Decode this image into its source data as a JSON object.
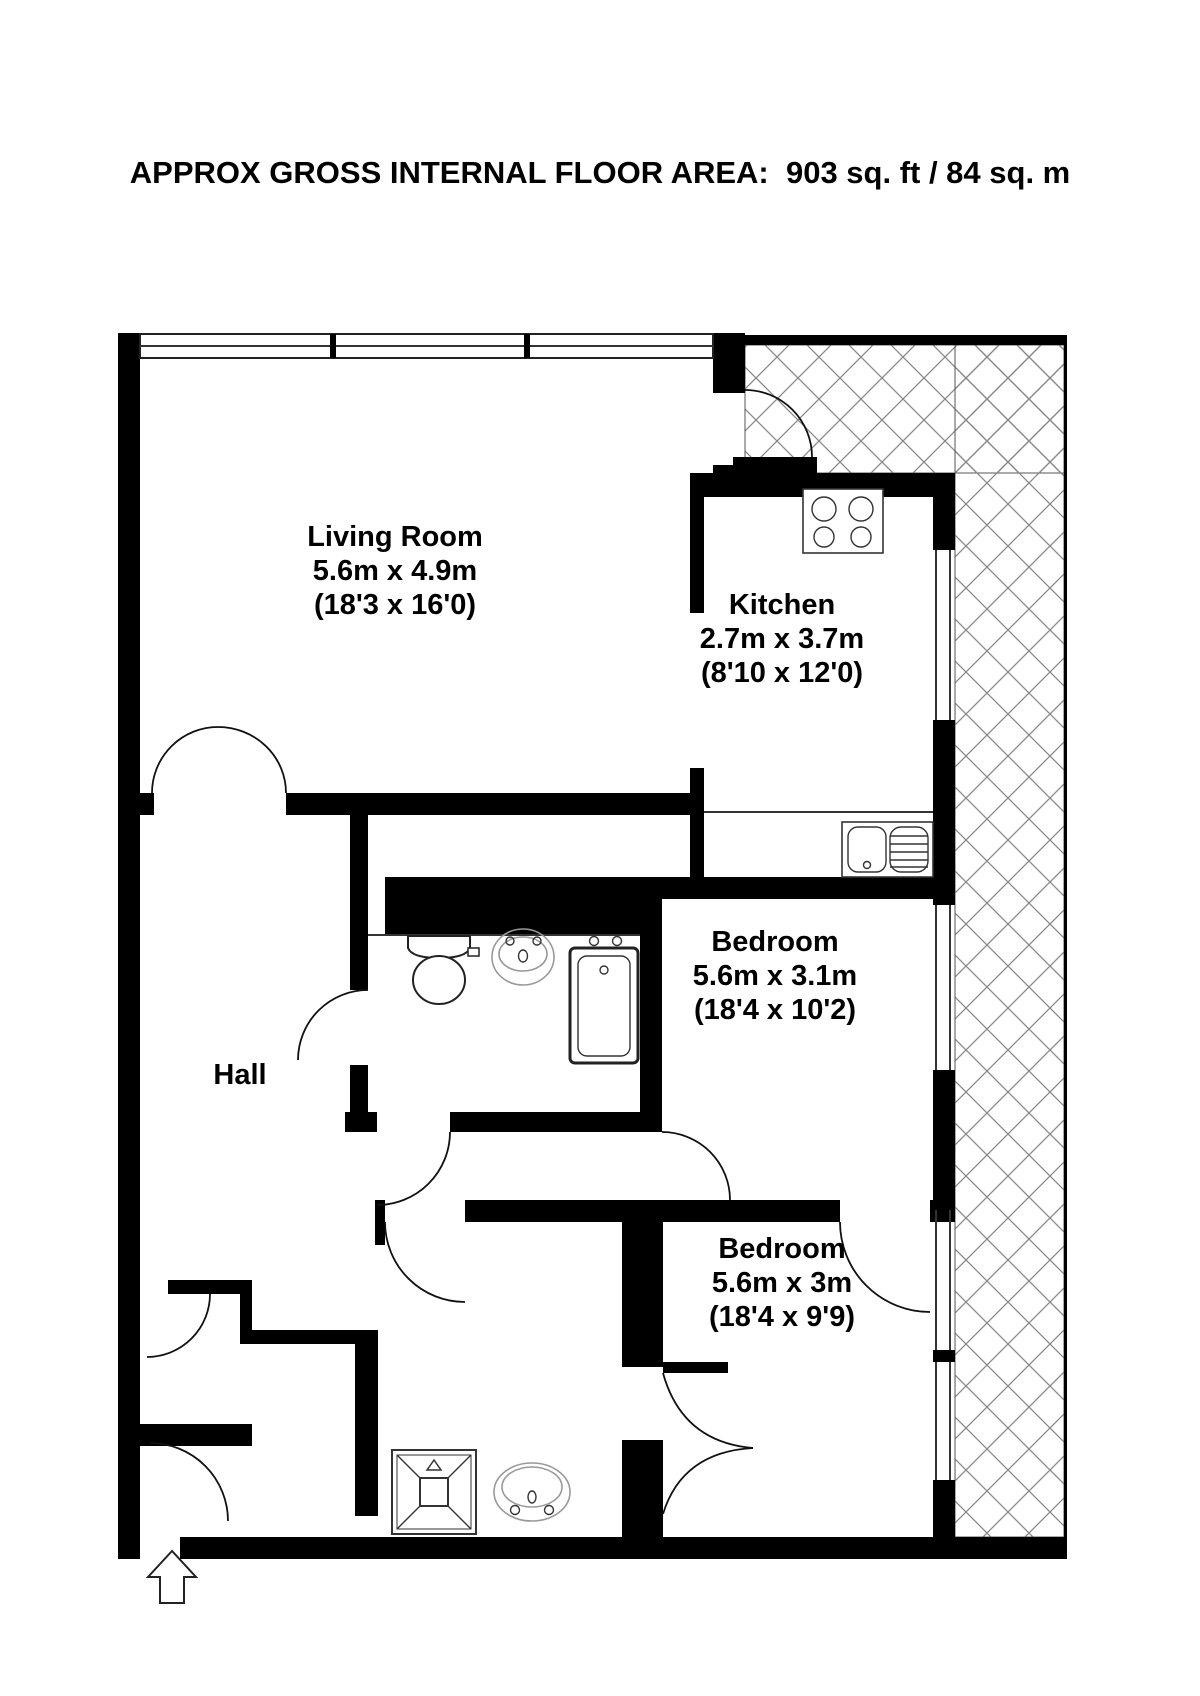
{
  "title": "APPROX GROSS INTERNAL FLOOR AREA:  903 sq. ft / 84 sq. m",
  "rooms": {
    "living_room": {
      "name": "Living Room",
      "metric": "5.6m x 4.9m",
      "imperial": "(18'3 x 16'0)"
    },
    "kitchen": {
      "name": "Kitchen",
      "metric": "2.7m x 3.7m",
      "imperial": "(8'10 x 12'0)"
    },
    "bedroom_1": {
      "name": "Bedroom",
      "metric": "5.6m x 3.1m",
      "imperial": "(18'4 x 10'2)"
    },
    "bedroom_2": {
      "name": "Bedroom",
      "metric": "5.6m x 3m",
      "imperial": "(18'4 x 9'9)"
    },
    "hall": {
      "name": "Hall"
    }
  },
  "fixtures": [
    "hob-icon",
    "kitchen-sink-icon",
    "toilet-icon",
    "washbasin-icon",
    "bathtub-icon",
    "shower-icon",
    "washbasin-2-icon",
    "entry-arrow-icon"
  ],
  "colors": {
    "wall": "#000000",
    "background": "#ffffff",
    "hatch_line": "#888888",
    "fixture_line": "#333333"
  }
}
